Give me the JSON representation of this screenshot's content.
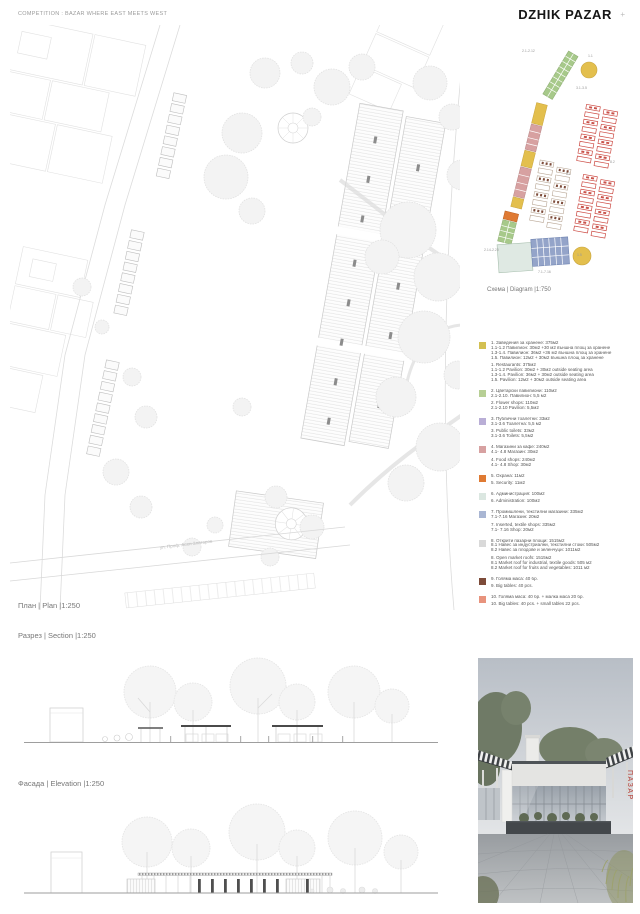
{
  "header": {
    "competition_label": "COMPETITION : BAZAR WHERE EAST MEETS WEST",
    "project_title": "DZHIK PAZAR",
    "page_mark": "+"
  },
  "plan": {
    "caption": "План | Plan |1:250",
    "street_label": "ул. Проф. Асен Златаров"
  },
  "section": {
    "caption": "Разрез | Section |1:250"
  },
  "elevation": {
    "caption": "Фасада | Elevation |1:250"
  },
  "diagram": {
    "caption": "Схема | Diagram |1:750",
    "colors": {
      "yellow": "#e3bf4d",
      "green": "#a7c98a",
      "pink": "#d7a1a1",
      "red": "#c9524a",
      "brown": "#7d4b39",
      "blue": "#94a4c9",
      "light_green": "#dfe9e3",
      "security_orange": "#df7a33"
    },
    "annotations": [
      {
        "text": "2.1-2.12",
        "x": 44,
        "y": 7
      },
      {
        "text": "1.1",
        "x": 110,
        "y": 12
      },
      {
        "text": "3.1-3.5",
        "x": 98,
        "y": 44
      },
      {
        "text": "8.2",
        "x": 132,
        "y": 118
      },
      {
        "text": "8.1",
        "x": 88,
        "y": 130
      },
      {
        "text": "2.14-2.20",
        "x": 6,
        "y": 206
      },
      {
        "text": "7.1-7.16",
        "x": 60,
        "y": 228
      },
      {
        "text": "1.5",
        "x": 99,
        "y": 211
      }
    ]
  },
  "legend": {
    "items": [
      {
        "color": "#d3c052",
        "bg_lines": [
          "1. Заведения за хранене: 375м2",
          "1.1-1.2 Павилион: 30м2 +30 м2 външна площ за хранене",
          "1.3-1.4. Павилион: 36м2 +36 м2 външна площ за хранене",
          "1.5. Павилион: 12м2 + 30м2 външна площ за хранене"
        ],
        "en_lines": [
          "1. Restaurants: 375м2",
          "1.1-1.2 Pavilion: 30м2 + 30м2 outside seating area",
          "1.3-1.4. Pavilion: 36м2 + 30м2 outside seating area",
          "1.5. Pavilion: 12м2 + 30м2 outside seating area"
        ]
      },
      {
        "color": "#b7cf95",
        "bg_lines": [
          "2. Цветарски павилиони: 110м2",
          "2.1-2.10. Павилион: 5,5 м2"
        ],
        "en_lines": [
          "2. Flower shops: 110м2",
          "2.1-2.10 Pavilion: 5,5м2"
        ]
      },
      {
        "color": "#b9aed6",
        "bg_lines": [
          "3. Публични тоалетни: 33м2",
          "3.1-3.6 Тоалетна: 5,5 м2"
        ],
        "en_lines": [
          "3. Public toilets: 33м2",
          "3.1-3.6 Toilets: 5,5м2"
        ]
      },
      {
        "color": "#d7a1a1",
        "bg_lines": [
          "4. Магазини за кафе: 240м2",
          "4.1- 4.8 Магазин: 30м2"
        ],
        "en_lines": [
          "4. Food shops: 240м2",
          "4.1- 4.8 Shop: 30м2"
        ]
      },
      {
        "color": "#df7a33",
        "bg_lines": [
          "5. Охрана: 11м2"
        ],
        "en_lines": [
          "5. Security: 11м2"
        ]
      },
      {
        "color": "#dbe7e1",
        "bg_lines": [
          "6. Администрация: 100м2"
        ],
        "en_lines": [
          "6. Administration: 100м2"
        ]
      },
      {
        "color": "#a9b6d3",
        "bg_lines": [
          "7. Промишлени, текстилни магазини: 335м2",
          "7.1-7.16 Магазин: 20м2"
        ],
        "en_lines": [
          "7. Inserted, textile shops: 335м2",
          "7.1- 7.16 Shop: 20м2"
        ]
      },
      {
        "color": "#d9d9d9",
        "bg_lines": [
          "8. Открити пазарни площи: 1515м2",
          "8.1 Навес за индустриални, текстилни стоки: 505м2",
          "8.2 Навес за плодове и зеленчуци: 1011м2"
        ],
        "en_lines": [
          "8. Open market roofs: 1515м2",
          "8.1 Market roof for industrial, textile goods: 505 м2",
          "8.2 Market roof for fruits and vegetables: 1011 м2"
        ]
      },
      {
        "color": "#7d4b39",
        "bg_lines": [
          "9. Голяма маса: 40 бр."
        ],
        "en_lines": [
          "9. Big tables: 40 pcs."
        ]
      },
      {
        "color": "#e8937d",
        "bg_lines": [
          "10. Голяма маса: 40 бр. + малка маса 20 бр."
        ],
        "en_lines": [
          "10. Big tables: 40 pcs. + small tables 22 pcs."
        ]
      }
    ]
  },
  "photo": {
    "sign_text": "ПАЗАР"
  }
}
